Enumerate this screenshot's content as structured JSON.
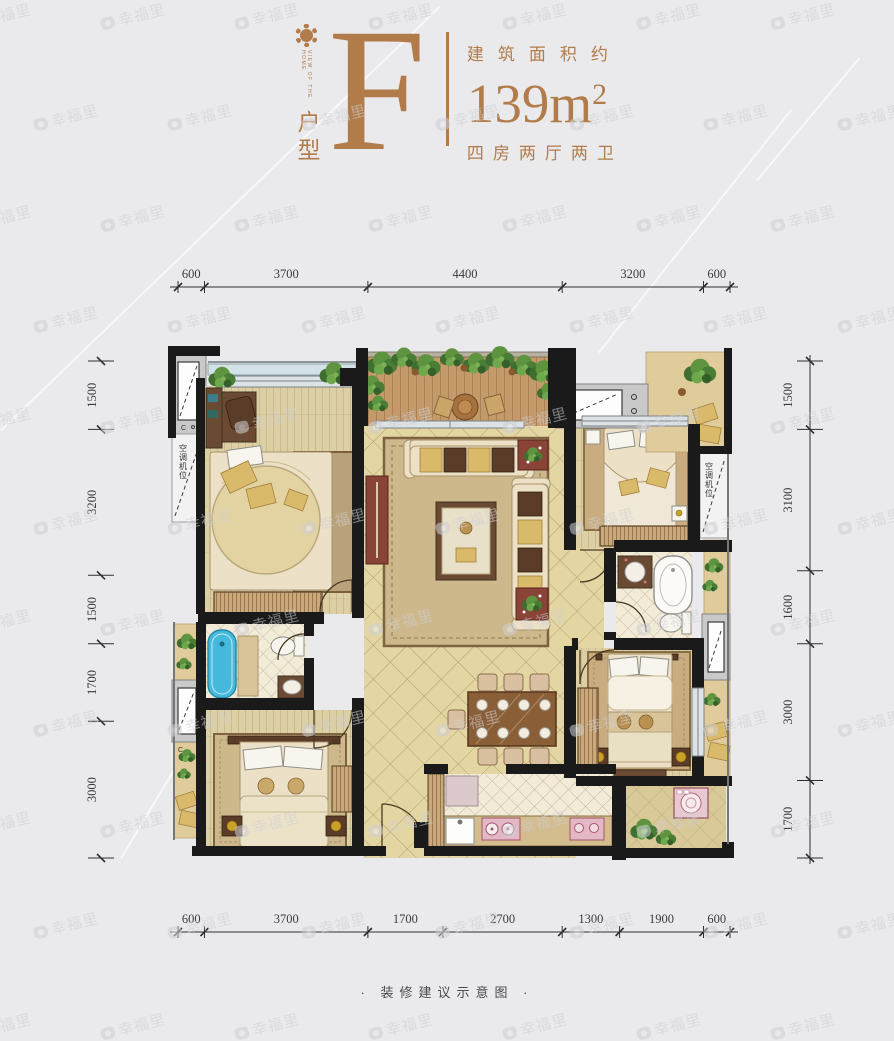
{
  "header": {
    "logo_text": "VIEW OF THE HOME",
    "type_label": "户型",
    "type_letter": "F",
    "area_label": "建筑面积约",
    "area_value": "139m",
    "area_sup": "2",
    "rooms_label": "四房两厅两卫",
    "accent_color": "#b27c4a"
  },
  "plan": {
    "ac_label_left": "空调机位",
    "ac_label_right": "空调机位",
    "equip_label": "C"
  },
  "dimensions": {
    "top": [
      600,
      3700,
      4400,
      3200,
      600
    ],
    "bottom": [
      600,
      3700,
      1700,
      2700,
      1300,
      1900,
      600
    ],
    "left": [
      1500,
      3200,
      1500,
      1700,
      3000
    ],
    "right": [
      1500,
      3100,
      1600,
      3000,
      1700
    ]
  },
  "footer": {
    "caption": "· 装修建议示意图 ·"
  },
  "watermark": {
    "text": "幸福里"
  }
}
